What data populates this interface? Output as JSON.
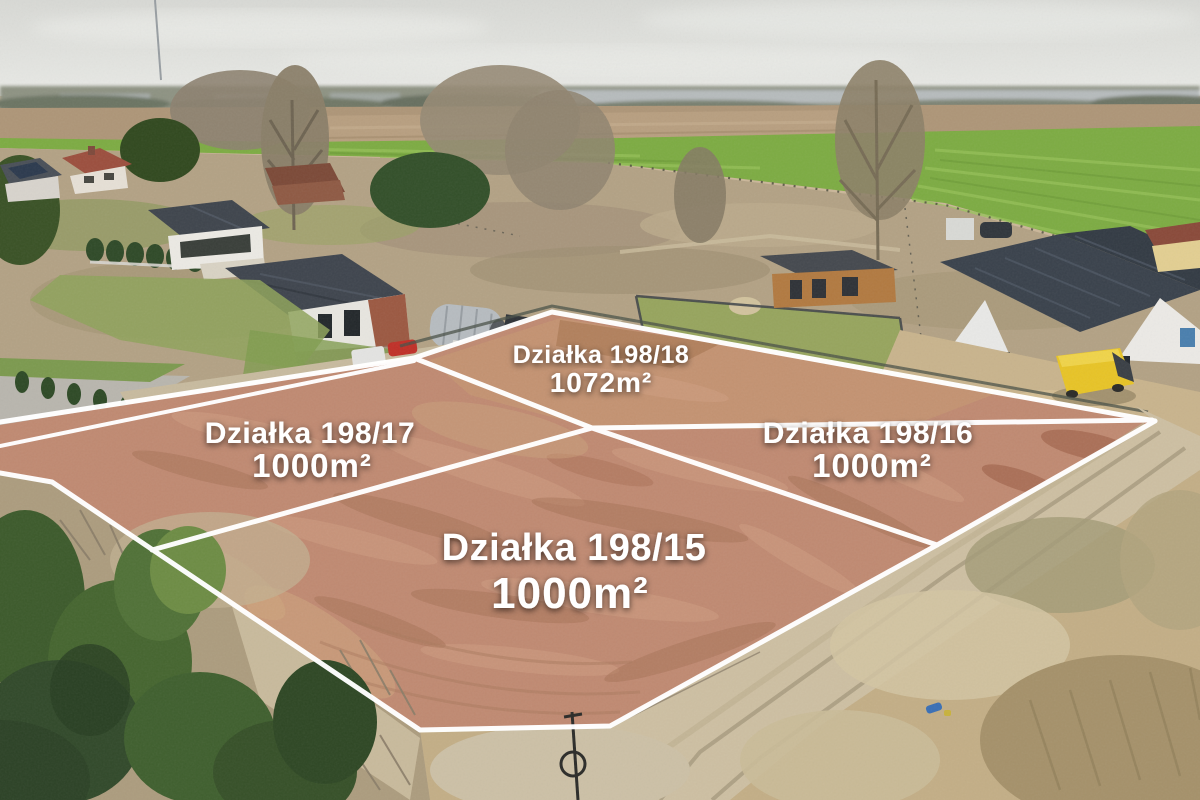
{
  "photo": {
    "description_label": "aerial drone photo of building plots for sale",
    "palette": {
      "boundary_line": "#ffffff",
      "label_text": "#ffffff",
      "plot_soil": "#c08a72",
      "grass_green": "#7dac43",
      "dark_roof": "#3a424c",
      "van_yellow": "#e8c427"
    }
  },
  "plots": [
    {
      "name_label": "Działka 198/18",
      "area_label": "1072m²"
    },
    {
      "name_label": "Działka 198/17",
      "area_label": "1000m²"
    },
    {
      "name_label": "Działka 198/16",
      "area_label": "1000m²"
    },
    {
      "name_label": "Działka 198/15",
      "area_label": "1000m²"
    }
  ]
}
